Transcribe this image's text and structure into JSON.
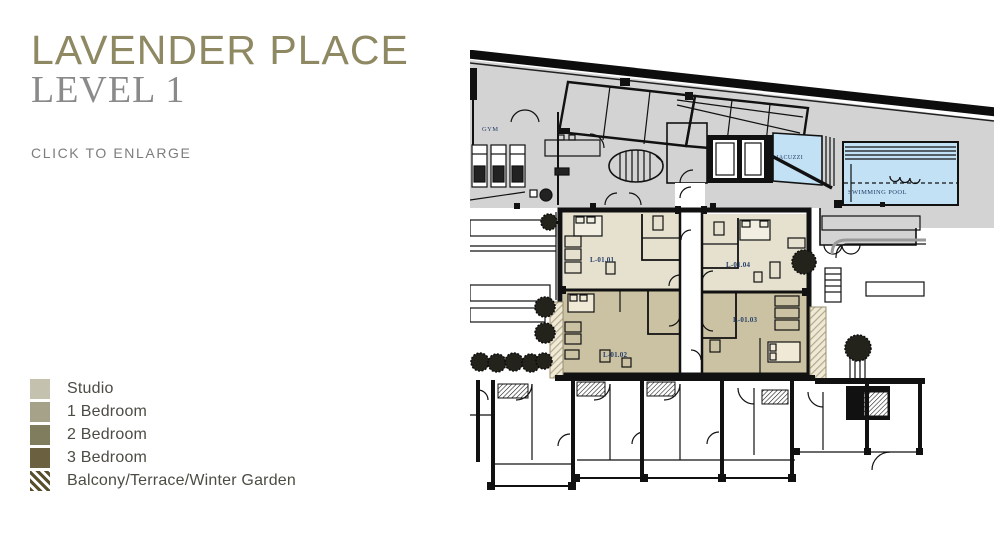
{
  "header": {
    "title": "LAVENDER PLACE",
    "subtitle": "LEVEL 1",
    "enlarge_hint": "CLICK TO ENLARGE"
  },
  "legend": {
    "items": [
      {
        "label": "Studio",
        "swatch": "studio"
      },
      {
        "label": "1 Bedroom",
        "swatch": "one_bed"
      },
      {
        "label": "2 Bedroom",
        "swatch": "two_bed"
      },
      {
        "label": "3 Bedroom",
        "swatch": "three_bed"
      },
      {
        "label": "Balcony/Terrace/Winter Garden",
        "swatch": "hatch"
      }
    ]
  },
  "floorplan": {
    "amenity_labels": {
      "gym": "GYM",
      "jacuzzi": "JACUZZI",
      "pool": "SWIMMING POOL"
    },
    "units": [
      {
        "id": "L-01.01",
        "type": "studio"
      },
      {
        "id": "L-01.02",
        "type": "1 bedroom"
      },
      {
        "id": "L-01.03",
        "type": "1 bedroom"
      },
      {
        "id": "L-01.04",
        "type": "studio"
      }
    ]
  },
  "colors": {
    "accent": "#8e8963",
    "level_gray": "#8a8a8a",
    "hint_gray": "#7d7d7d",
    "legend_text": "#4c4c44",
    "studio": "#c4c2ae",
    "one_bed": "#a5a289",
    "two_bed": "#807d5f",
    "three_bed": "#6b6040",
    "hatch": "#57502f",
    "plan_gray": "#d3d3d3",
    "unit_light": "#e5e1ce",
    "unit_tan": "#cbc2a3",
    "pool_blue": "#c3e1f4",
    "label_navy": "#253f6a"
  }
}
